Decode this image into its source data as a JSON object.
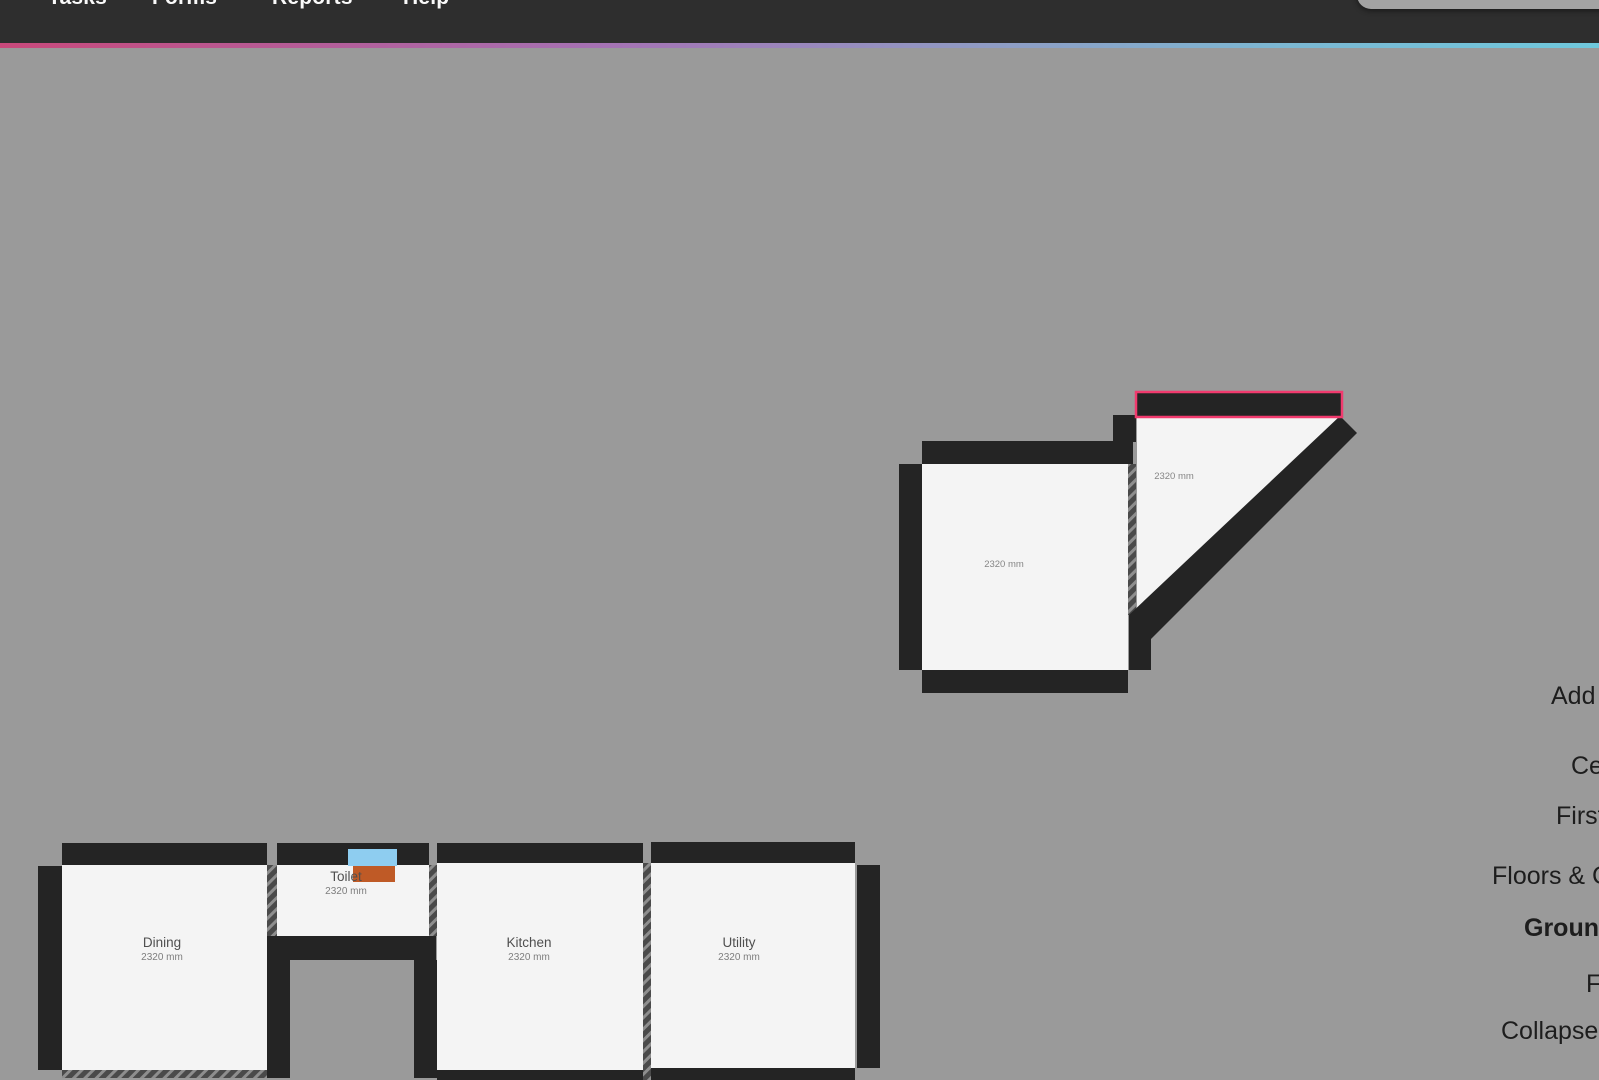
{
  "menubar": {
    "items": [
      {
        "label": "Tasks"
      },
      {
        "label": "Forms"
      },
      {
        "label": "Reports"
      },
      {
        "label": "Help"
      }
    ]
  },
  "right_panel": {
    "items": [
      {
        "label": "Add L"
      },
      {
        "label": "Cei"
      },
      {
        "label": "First"
      },
      {
        "label": "Floors & Cei"
      },
      {
        "label": "Ground",
        "bold": true
      },
      {
        "label": "F"
      },
      {
        "label": "Collapse Le"
      }
    ]
  },
  "floorplan": {
    "rooms": [
      {
        "name": "",
        "dimension": "2320 mm"
      },
      {
        "name": "",
        "dimension": "2320 mm"
      },
      {
        "name": "Dining",
        "dimension": "2320 mm"
      },
      {
        "name": "Toilet",
        "dimension": "2320 mm"
      },
      {
        "name": "Kitchen",
        "dimension": "2320 mm"
      },
      {
        "name": "Utility",
        "dimension": "2320 mm"
      }
    ],
    "colors": {
      "canvas": "#9a9a9a",
      "wall": "#242424",
      "floor": "#f4f4f4",
      "selection_outline": "#f13a6e",
      "fixture_blue": "#8ecdf0",
      "fixture_orange": "#bf5a26",
      "hatch_dark": "#4a4a4a",
      "hatch_light": "#8e8e8e",
      "topbar": "#2e2e2e",
      "accent_gradient": [
        "#c9497b",
        "#a573b4",
        "#6fc8dc"
      ]
    }
  }
}
